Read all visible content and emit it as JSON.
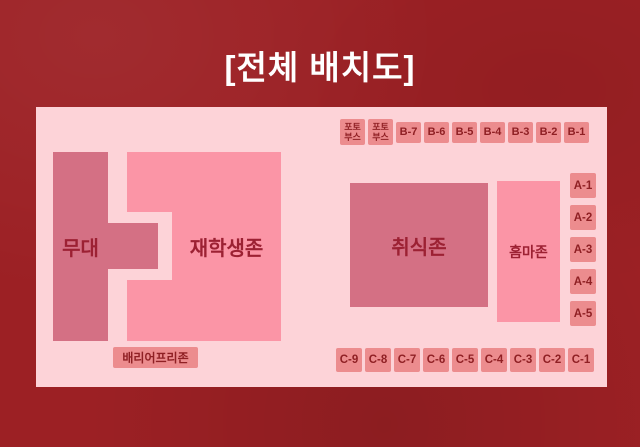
{
  "title": "[전체 배치도]",
  "palette": {
    "background_red": "#9c2024",
    "panel_pink": "#fdd3d8",
    "dark_zone_pink": "#d47084",
    "light_zone_pink": "#fb95a6",
    "seat_box_salmon": "#ec8c8e",
    "label_dark_red": "#8f2024",
    "title_white": "#ffffff"
  },
  "map": {
    "zones": {
      "stage": {
        "label": "무대"
      },
      "students": {
        "label": "재학생존"
      },
      "food": {
        "label": "취식존"
      },
      "homma": {
        "label": "홈마존"
      },
      "barrier_free": {
        "label": "배리어프리존"
      }
    },
    "photo_booths": [
      {
        "top": "포토",
        "bottom": "부스"
      },
      {
        "top": "포토",
        "bottom": "부스"
      }
    ],
    "b_row": [
      "B-7",
      "B-6",
      "B-5",
      "B-4",
      "B-3",
      "B-2",
      "B-1"
    ],
    "a_column": [
      "A-1",
      "A-2",
      "A-3",
      "A-4",
      "A-5"
    ],
    "c_row": [
      "C-9",
      "C-8",
      "C-7",
      "C-6",
      "C-5",
      "C-4",
      "C-3",
      "C-2",
      "C-1"
    ]
  }
}
